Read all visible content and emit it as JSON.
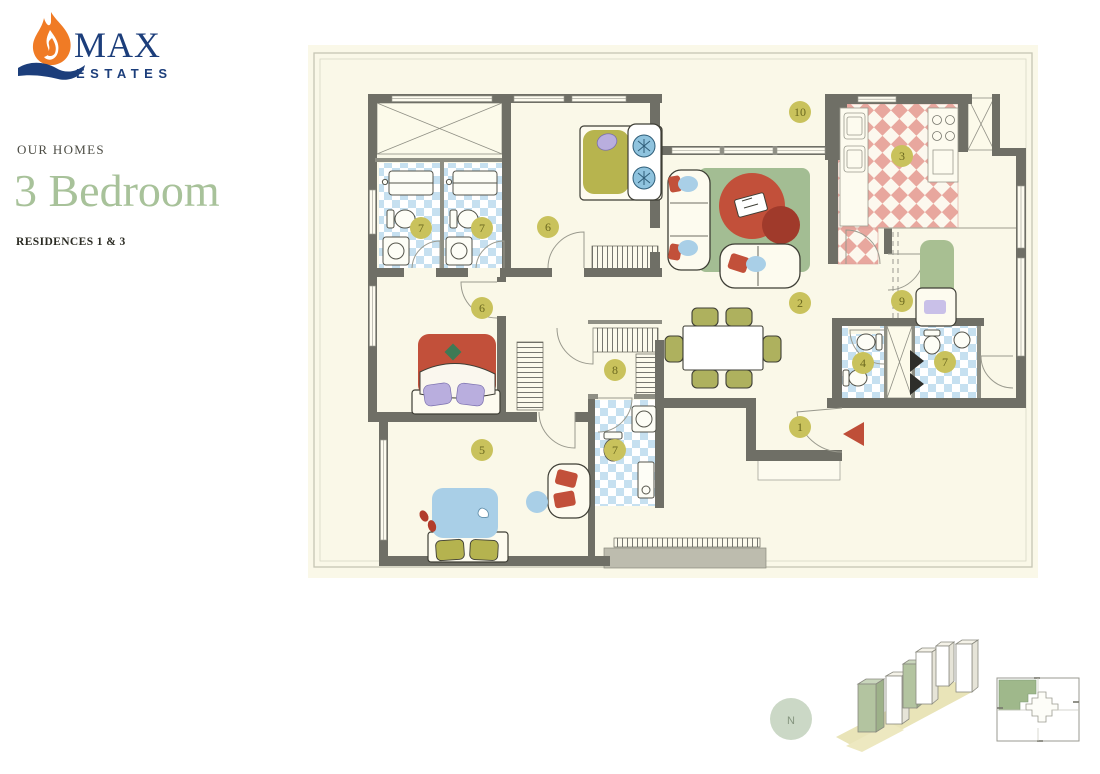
{
  "brand": {
    "name": "MAX",
    "tagline": "ESTATES",
    "orange": "#F07B25",
    "navy": "#1C3E7B"
  },
  "heading": {
    "eyebrow": "OUR HOMES",
    "title": "3 Bedroom",
    "subtitle": "RESIDENCES 1 & 3",
    "title_color": "#A8C29A"
  },
  "floorplan": {
    "background": "#FAF8E8",
    "wall_color": "#6F6F66",
    "entrance_arrow_color": "#BF4E38",
    "marker_style": {
      "fill": "#C9C25C",
      "text_color": "#6B681F"
    },
    "markers": [
      {
        "label": "1",
        "x": 800,
        "y": 427
      },
      {
        "label": "2",
        "x": 800,
        "y": 303
      },
      {
        "label": "3",
        "x": 902,
        "y": 156
      },
      {
        "label": "4",
        "x": 863,
        "y": 363
      },
      {
        "label": "5",
        "x": 482,
        "y": 450
      },
      {
        "label": "6",
        "x": 548,
        "y": 227
      },
      {
        "label": "6",
        "x": 482,
        "y": 308
      },
      {
        "label": "7",
        "x": 421,
        "y": 228
      },
      {
        "label": "7",
        "x": 482,
        "y": 228
      },
      {
        "label": "7",
        "x": 615,
        "y": 450
      },
      {
        "label": "7",
        "x": 945,
        "y": 362
      },
      {
        "label": "8",
        "x": 615,
        "y": 370
      },
      {
        "label": "9",
        "x": 902,
        "y": 301
      },
      {
        "label": "10",
        "x": 800,
        "y": 112
      }
    ],
    "palette": {
      "bath_check": "#C6E0F0",
      "kitchen_check": "#E8A79E",
      "rug_green": "#A3BD93",
      "accent_red": "#C2503A",
      "accent_dark_red": "#A03A2B",
      "bed_olive": "#B7B44E",
      "bed_blue": "#A9CFE7",
      "pillow_purple": "#B9AEDE",
      "utility_green": "#A8BF92",
      "chair_olive": "#AEB15E"
    }
  },
  "legend": {
    "compass_label": "N"
  }
}
